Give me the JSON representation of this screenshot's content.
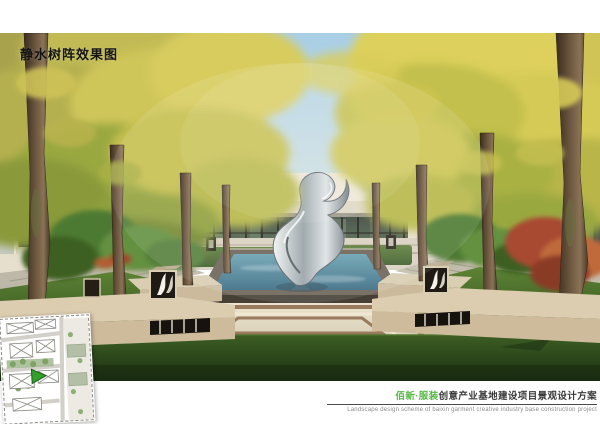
{
  "board": {
    "title": "静水树阵效果图",
    "caption": {
      "project_highlight": "佰新·服装",
      "project_rest": "创意产业基地建设项目景观设计方案",
      "subtitle_en": "Landscape design scheme of baixin garment creative industry base construction project"
    },
    "colors": {
      "highlight_green": "#57b847",
      "caption_dark": "#3a3a3a",
      "caption_sub_gray": "#8a8a8a",
      "title_black": "#141414",
      "sky_blue": "#a8cee6",
      "ginkgo_yellow": "#d0c655",
      "pool_teal": "#4f8398",
      "lawn_green": "#4f762e",
      "foreground_lawn": "#2c4519",
      "paving_cream": "#e9e1cd",
      "band_brown": "#9a7a5e",
      "stone_beige": "#dcccb0",
      "building_cream": "#efe8d8",
      "glass_green": "#46543f",
      "sculpture_metal": "#c6ced2",
      "maple_red": "#b05438",
      "plan_marker_green": "#33a02c"
    },
    "scene": {
      "elements": [
        "sky",
        "left-building",
        "right-building",
        "glass-pavilion",
        "hedges",
        "ginkgo-tree-rows",
        "reflecting-pool",
        "metal-sculpture",
        "stone-planters",
        "leaf-pattern-lanterns",
        "paved-plaza",
        "side-walkways",
        "lawn",
        "red-maple",
        "site-plan-key"
      ]
    }
  }
}
